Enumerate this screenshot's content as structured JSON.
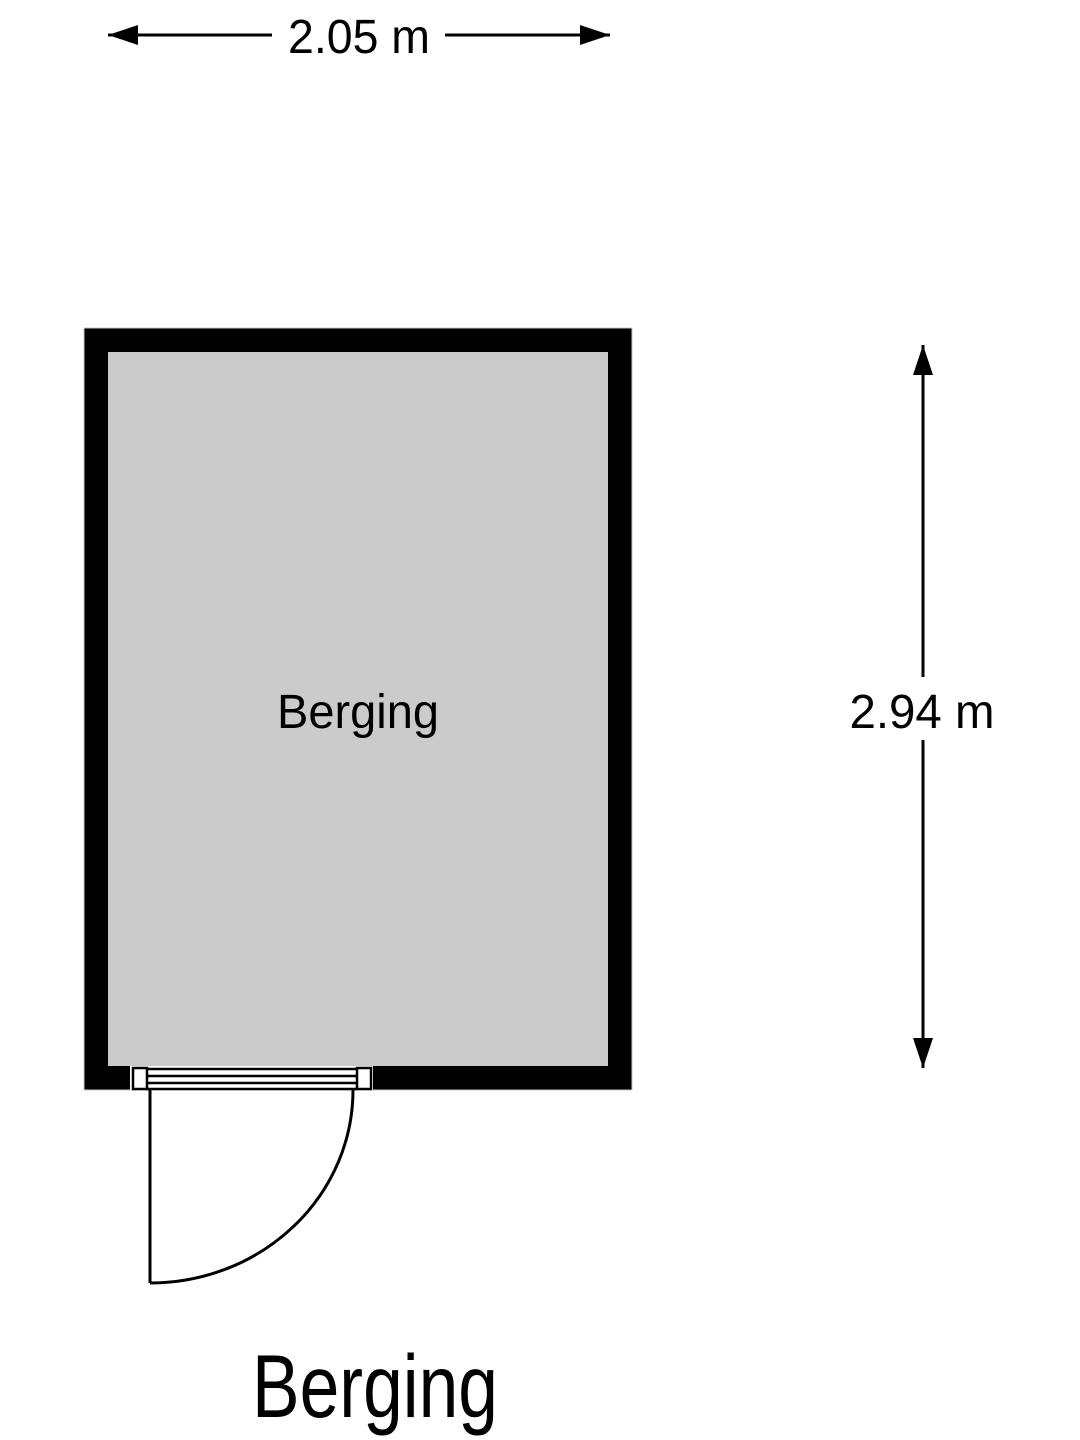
{
  "colors": {
    "wall": "#000000",
    "floor": "#cbcbcb",
    "wall_outline": "#c8c8c8",
    "line": "#000000",
    "text": "#000000",
    "background": "#ffffff"
  },
  "dimensions": {
    "width_label": "2.05 m",
    "width_value_m": 2.05,
    "height_label": "2.94 m",
    "height_value_m": 2.94
  },
  "room": {
    "label": "Berging"
  },
  "caption": {
    "label": "Berging"
  }
}
